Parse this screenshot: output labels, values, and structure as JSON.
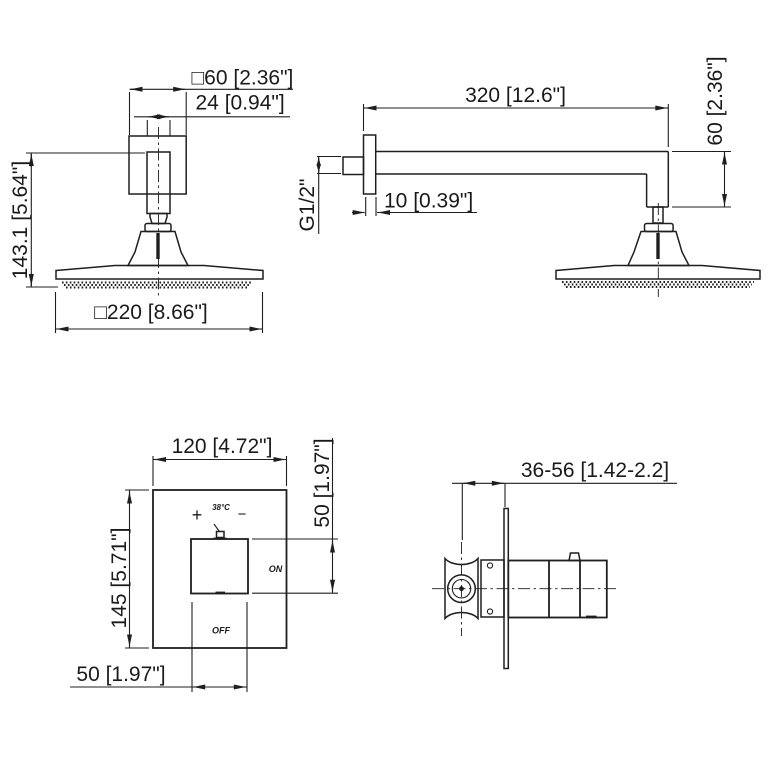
{
  "drawing": {
    "background": "#ffffff",
    "line_color": "#1f1f1f"
  },
  "views": {
    "showerhead_front": {
      "dims": {
        "flange_size": "□60 [2.36\"]",
        "stem_width": "24 [0.94\"]",
        "overall_height": "143.1 [5.64\"]",
        "head_size": "□220 [8.66\"]"
      }
    },
    "shower_arm_side": {
      "dims": {
        "arm_length": "320 [12.6\"]",
        "arm_drop": "60 [2.36\"]",
        "thread_size": "G1/2\"",
        "flange_thickness": "10 [0.39\"]"
      }
    },
    "valve_front": {
      "dims": {
        "plate_width": "120 [4.72\"]",
        "plate_height": "145 [5.71\"]",
        "knob_height": "50 [1.97\"]",
        "knob_width": "50 [1.97\"]"
      },
      "labels": {
        "plus": "+",
        "temp": "38°C",
        "minus": "−",
        "on": "ON",
        "off": "OFF"
      }
    },
    "valve_side": {
      "dims": {
        "wall_depth_range": "36-56 [1.42-2.2]"
      }
    }
  }
}
